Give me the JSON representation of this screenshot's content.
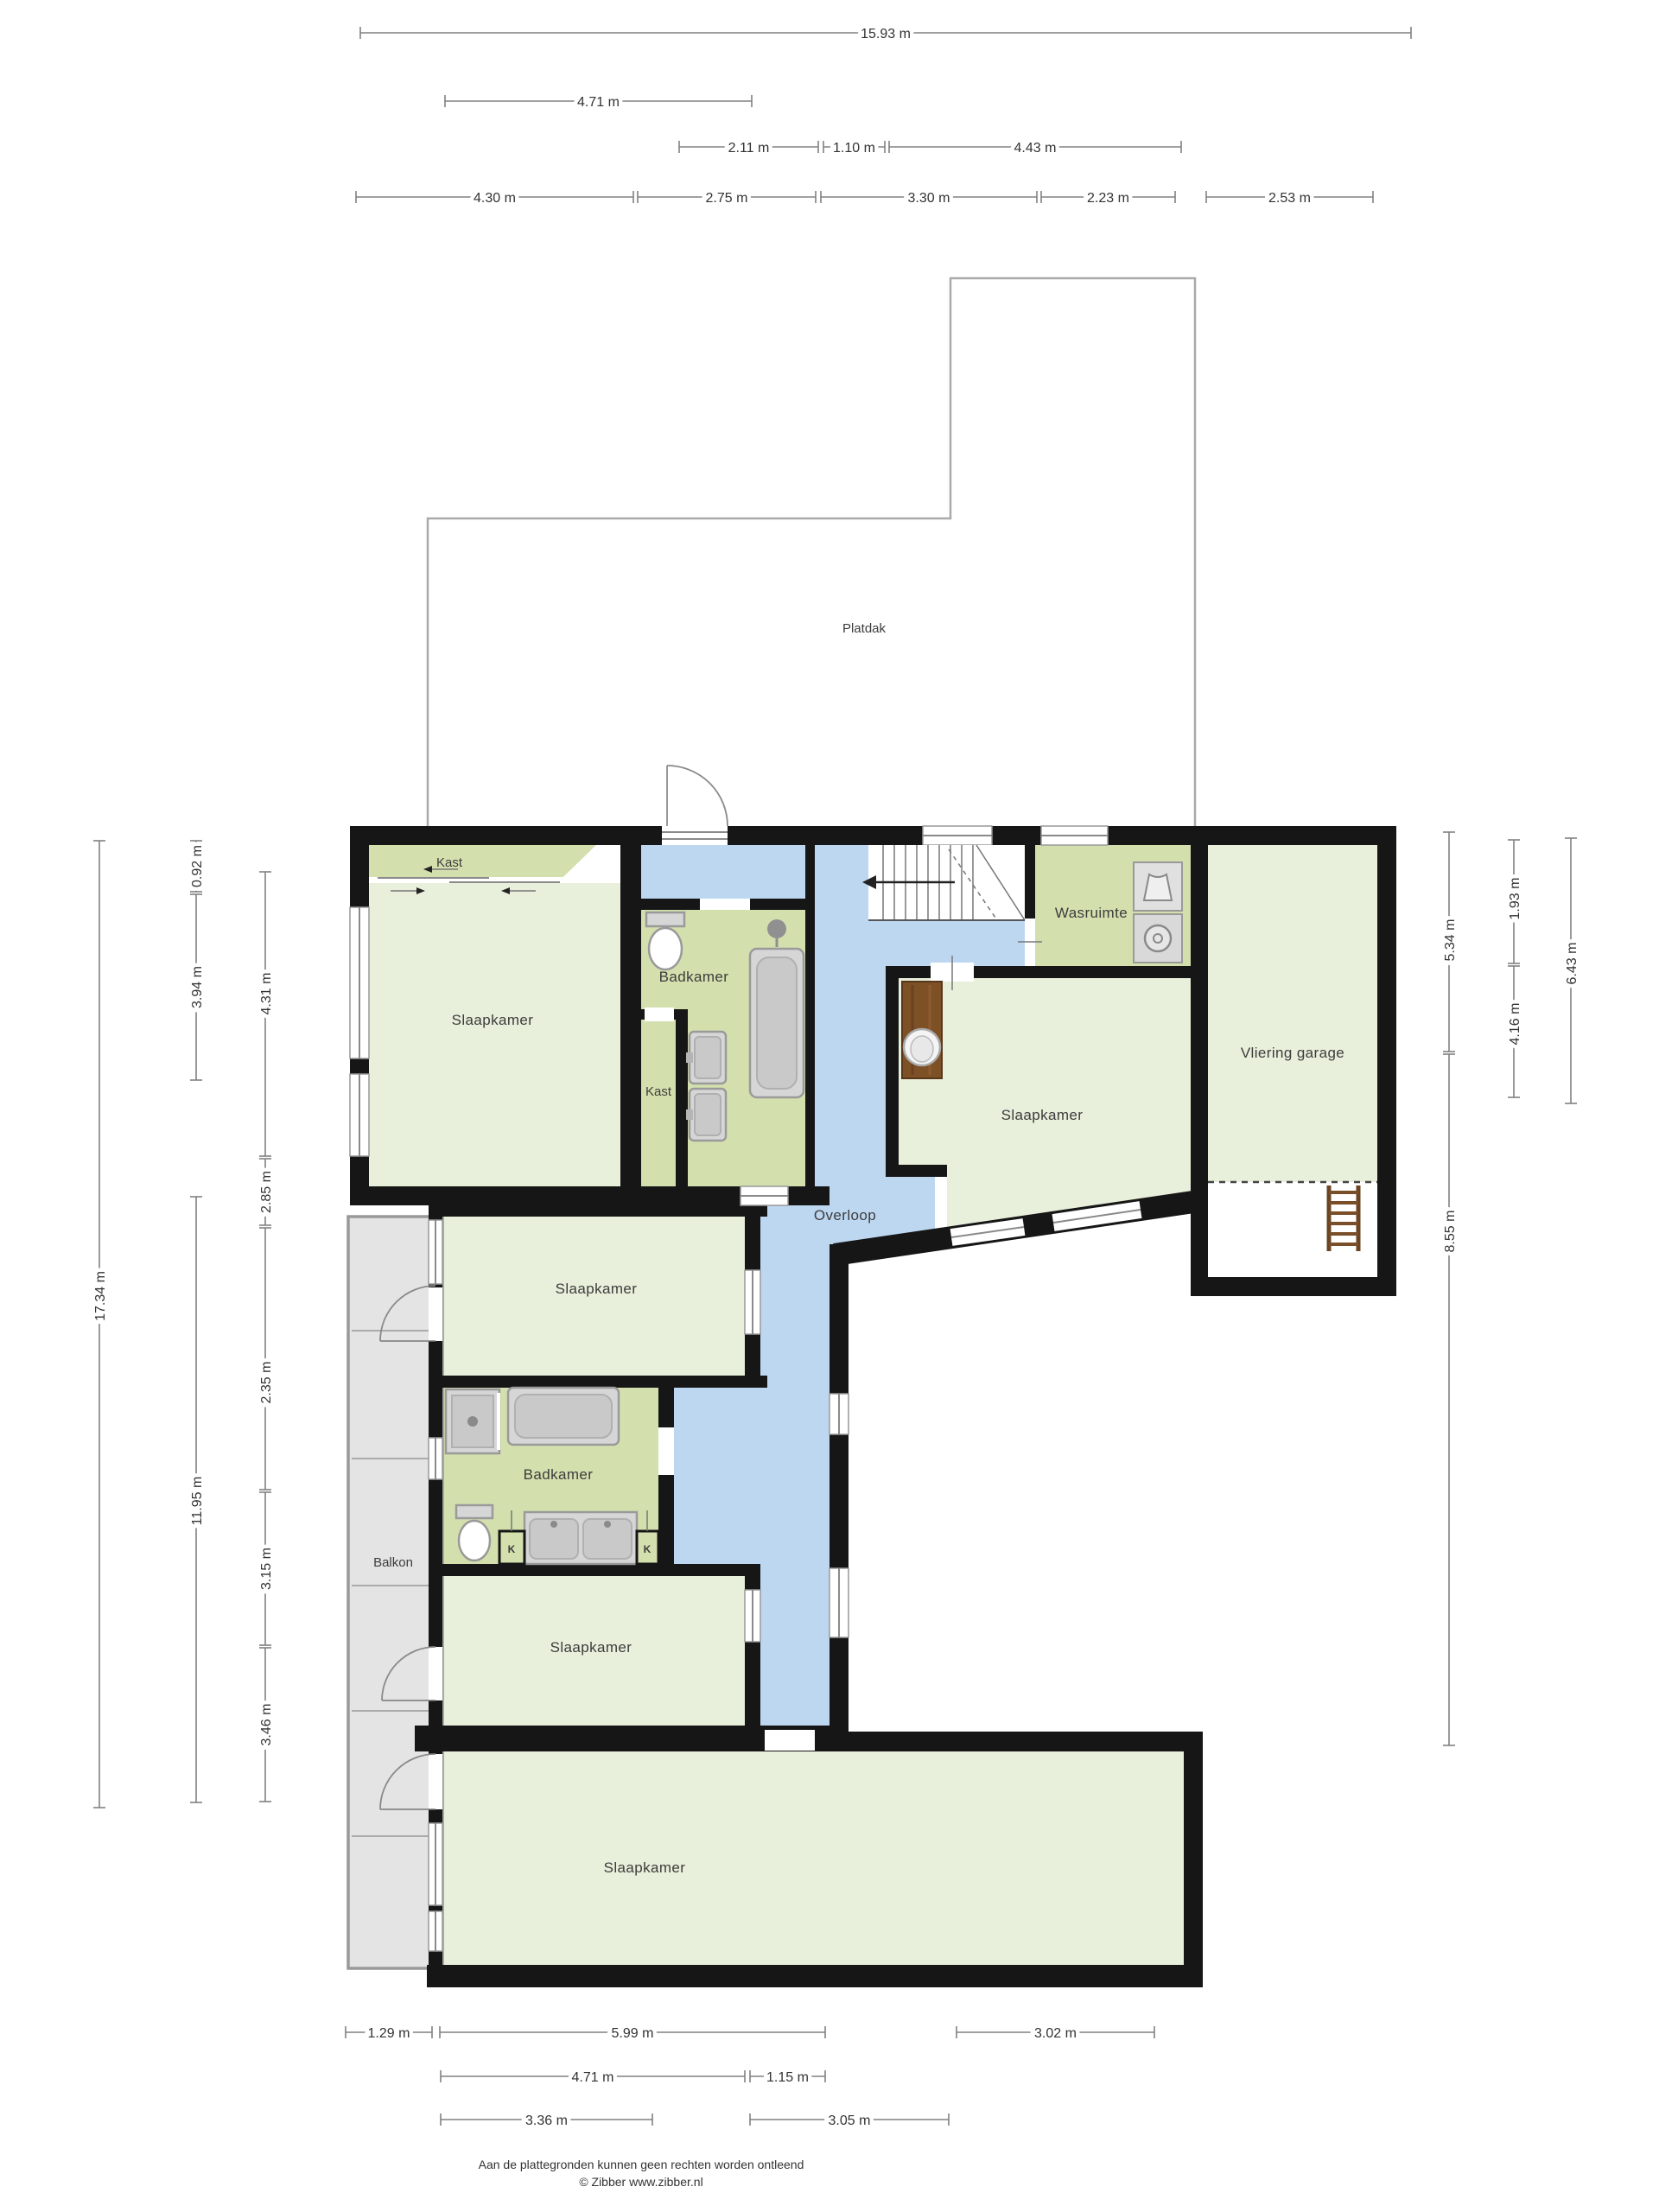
{
  "rooms": {
    "platdak": "Platdak",
    "kast_top": "Kast",
    "slaapkamer_tl": "Slaapkamer",
    "badkamer_top": "Badkamer",
    "kast_small": "Kast",
    "wasruimte": "Wasruimte",
    "vliering_garage": "Vliering garage",
    "slaapkamer_right": "Slaapkamer",
    "overloop": "Overloop",
    "slaapkamer_mid": "Slaapkamer",
    "badkamer_low": "Badkamer",
    "balkon": "Balkon",
    "k_left": "K",
    "k_right": "K",
    "slaapkamer_lowmid": "Slaapkamer",
    "slaapkamer_bottom": "Slaapkamer"
  },
  "dimensions": {
    "top": [
      "15.93 m",
      "4.71 m",
      "2.11 m",
      "1.10 m",
      "4.43 m",
      "4.30 m",
      "2.75 m",
      "3.30 m",
      "2.23 m",
      "2.53 m"
    ],
    "left": [
      "17.34 m",
      "0.92 m",
      "3.94 m",
      "11.95 m",
      "4.31 m",
      "2.85 m",
      "2.35 m",
      "3.15 m",
      "3.46 m"
    ],
    "right": [
      "5.34 m",
      "8.55 m",
      "1.93 m",
      "4.16 m",
      "6.43 m"
    ],
    "bottom": [
      "1.29 m",
      "5.99 m",
      "3.02 m",
      "4.71 m",
      "1.15 m",
      "3.36 m",
      "3.05 m"
    ]
  },
  "footer": {
    "line1": "Aan de plattegronden kunnen geen rechten worden ontleend",
    "line2": "© Zibber www.zibber.nl"
  },
  "colors": {
    "wall": "#161616",
    "room_green": "#e8efdb",
    "service_green": "#d3e0ae",
    "hallway_blue": "#bdd7f1",
    "balcony_gray": "#e4e4e4",
    "fixture_gray": "#d6d6d6",
    "wood_brown": "#7d5026",
    "dimension_line": "#808080",
    "text_dark": "#3c3c3c"
  }
}
